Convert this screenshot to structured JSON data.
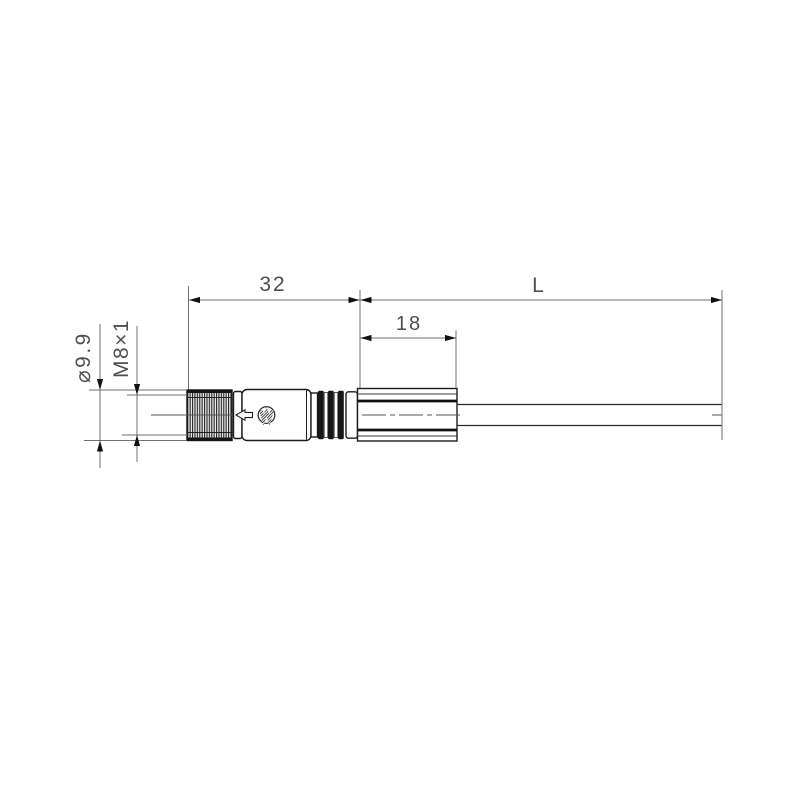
{
  "drawing": {
    "dimensions": {
      "connector_length": "32",
      "cable_length": "L",
      "sleeve_length": "18",
      "nut_diameter": "⌀9.9",
      "thread": "M8×1"
    },
    "icons": {
      "logo": "manufacturer-logo-icon",
      "direction_arrow": "left-direction-arrow-icon"
    },
    "colors": {
      "background": "#ffffff",
      "object_line": "#1c1c1c",
      "dimension_line": "#6f6f6f",
      "text": "#4f4f4f",
      "rib_fill": "#161616"
    }
  }
}
